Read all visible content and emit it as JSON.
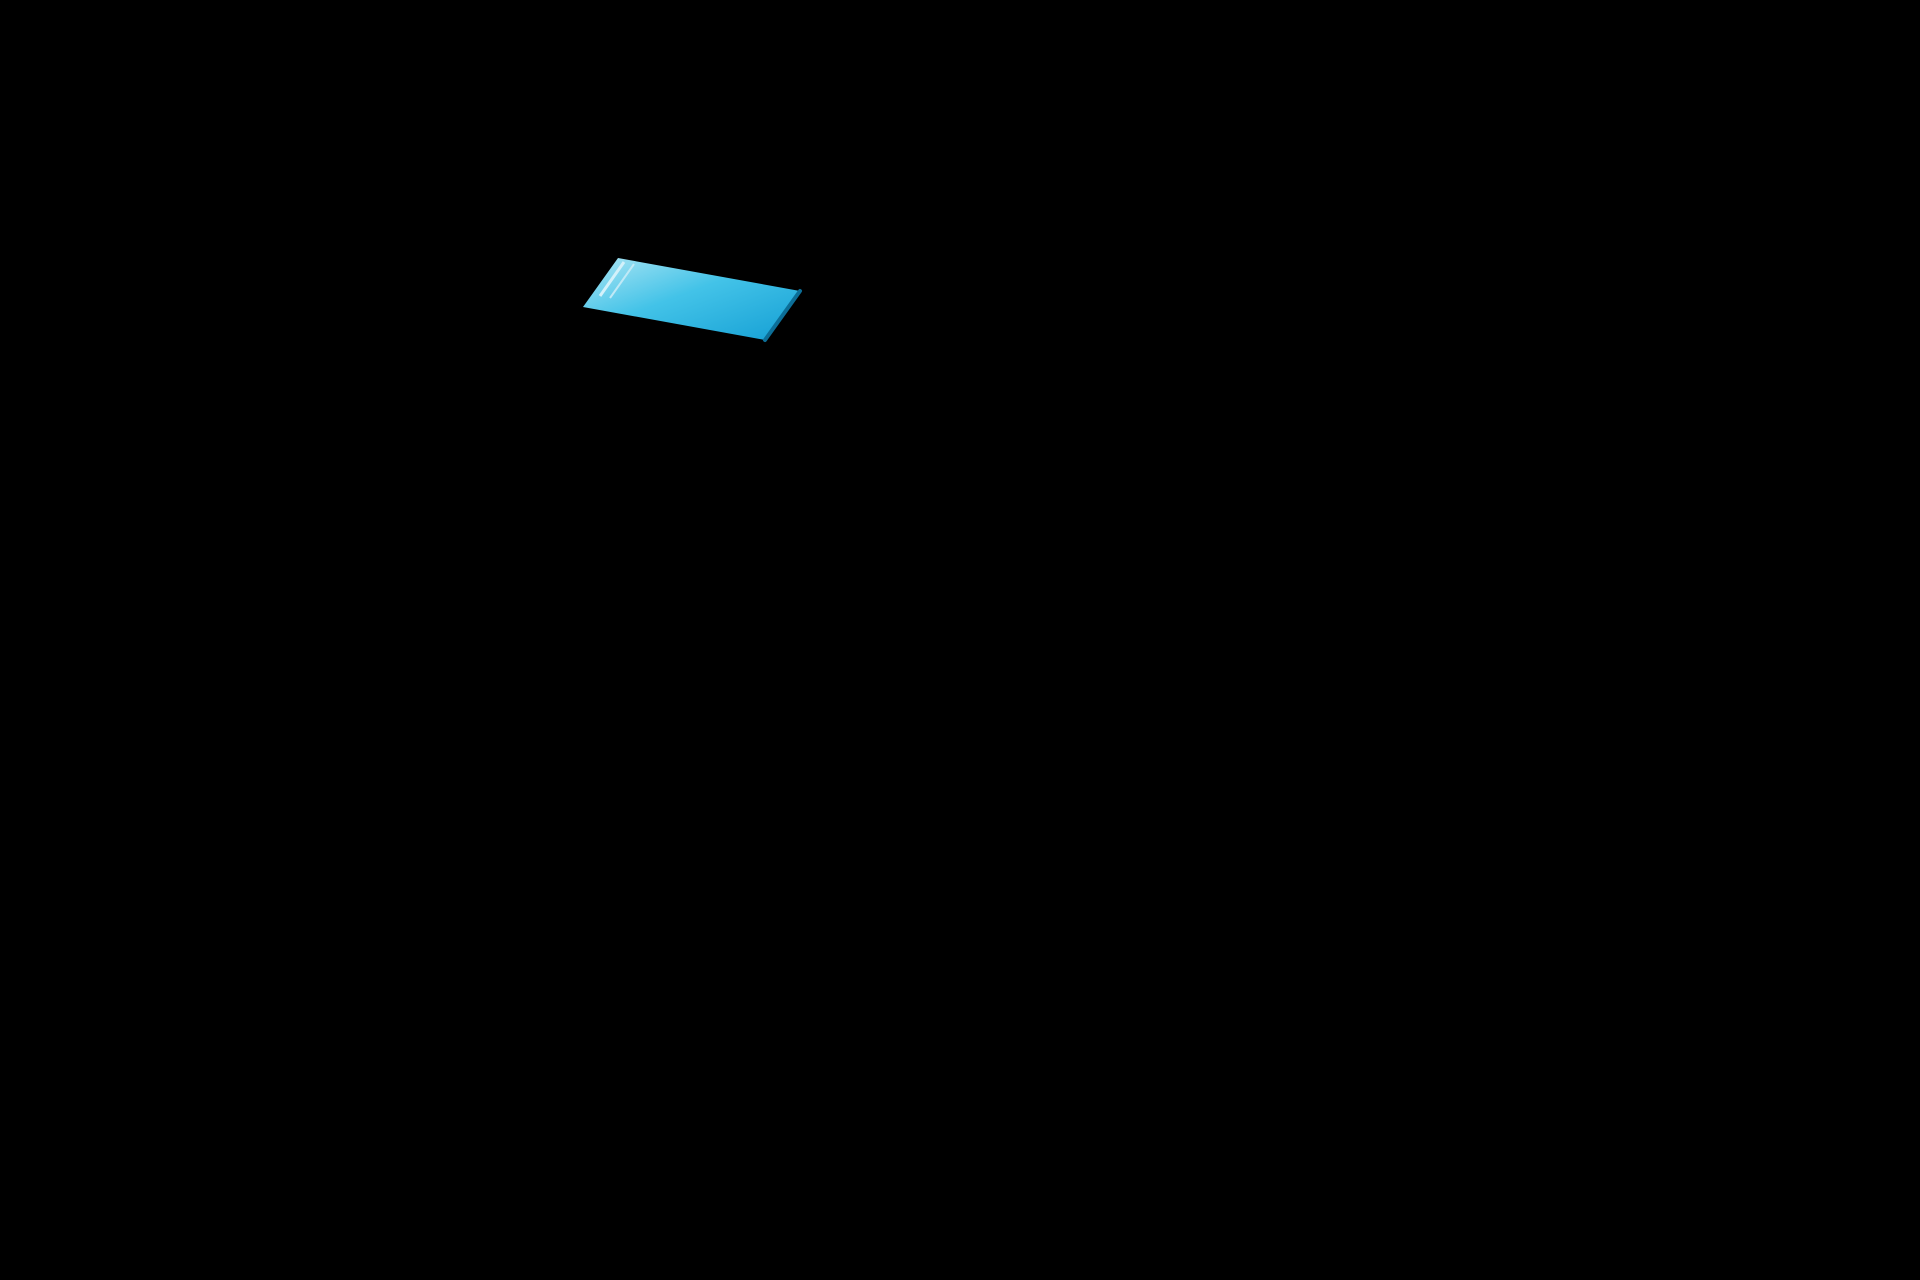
{
  "scene": {
    "title": "Aerial 3D render of a new-build residential development with communal pool",
    "description": "Photorealistic bird's-eye architectural visualization on a white background. An L-shaped gray asphalt road with rounded corners and a light sidewalk wraps an L-shaped plot of modern white two-storey townhouses with flat roof terraces, external staircases and dark window openings. The upper block encloses a communal garden with a large turquoise infinity pool, a children's pool, beige sun deck, white loungers, straw parasols and palm trees. A lower row of townhouses with private walled front gardens runs along a dark parking strip with white-lined bays. Several cars drive on the roads or sit parked in the bays."
  },
  "colors": {
    "background": "#ffffff",
    "road": "#909193",
    "sidewalk": "#d9dbdf",
    "curb": "#f3f4f6",
    "parking": "#7c797b",
    "bayLine": "#e9e7e2",
    "lawn": "#85b042",
    "gardenGrass": "#7fae3d",
    "poolWater": "#2fb9e2",
    "poolWaterLight": "#9fe0f2",
    "poolDeep": "#0e7fae",
    "poolShallow": "#a8e2f2",
    "poolDeck": "#dcd4bb",
    "deckSteps": "#4c3b28",
    "houseWhite": "#fbfcfd",
    "houseShade": "#e7eaee",
    "roofSlab": "#eceef1",
    "terraceBeige": "#e4ddcc",
    "windowDark": "#3b4552",
    "doorDark": "#2e3842",
    "glass": "#cfe3ec",
    "wallGray": "#8d96a1",
    "wallWhite": "#ffffff",
    "accentDark": "#5a6370",
    "palmGreen": "#3e7d35",
    "palmTrunk": "#9b8b6d",
    "parasolTan": "#c9ae7d",
    "treeGreen": "#6fa23c",
    "carWhite": "#f7f8f9",
    "carSilver": "#c3c7cc",
    "carDark": "#4b4f57",
    "carGray": "#9ba0a8",
    "personDark": "#4a4e55"
  },
  "inventory": {
    "townhouses_north_row": 8,
    "townhouses_west_row": 7,
    "townhouses_south_row": 8,
    "apartment_building": 1,
    "utility_building": 1,
    "pools_main": 1,
    "pools_children": 1,
    "palm_trees": 16,
    "parasols": 8,
    "sun_loungers": 7,
    "round_trees": 4,
    "parking_bay_lines": 19,
    "people": 2,
    "cars": [
      {
        "color": "silver",
        "state": "driving",
        "location": "west road"
      },
      {
        "color": "white",
        "state": "driving",
        "location": "west road"
      },
      {
        "color": "dark-gray",
        "state": "parked",
        "location": "parking bay"
      },
      {
        "color": "white",
        "state": "parked",
        "location": "parking bay"
      },
      {
        "color": "gray",
        "state": "driving",
        "location": "parking lane"
      },
      {
        "color": "white",
        "state": "driving",
        "location": "south road"
      }
    ]
  }
}
